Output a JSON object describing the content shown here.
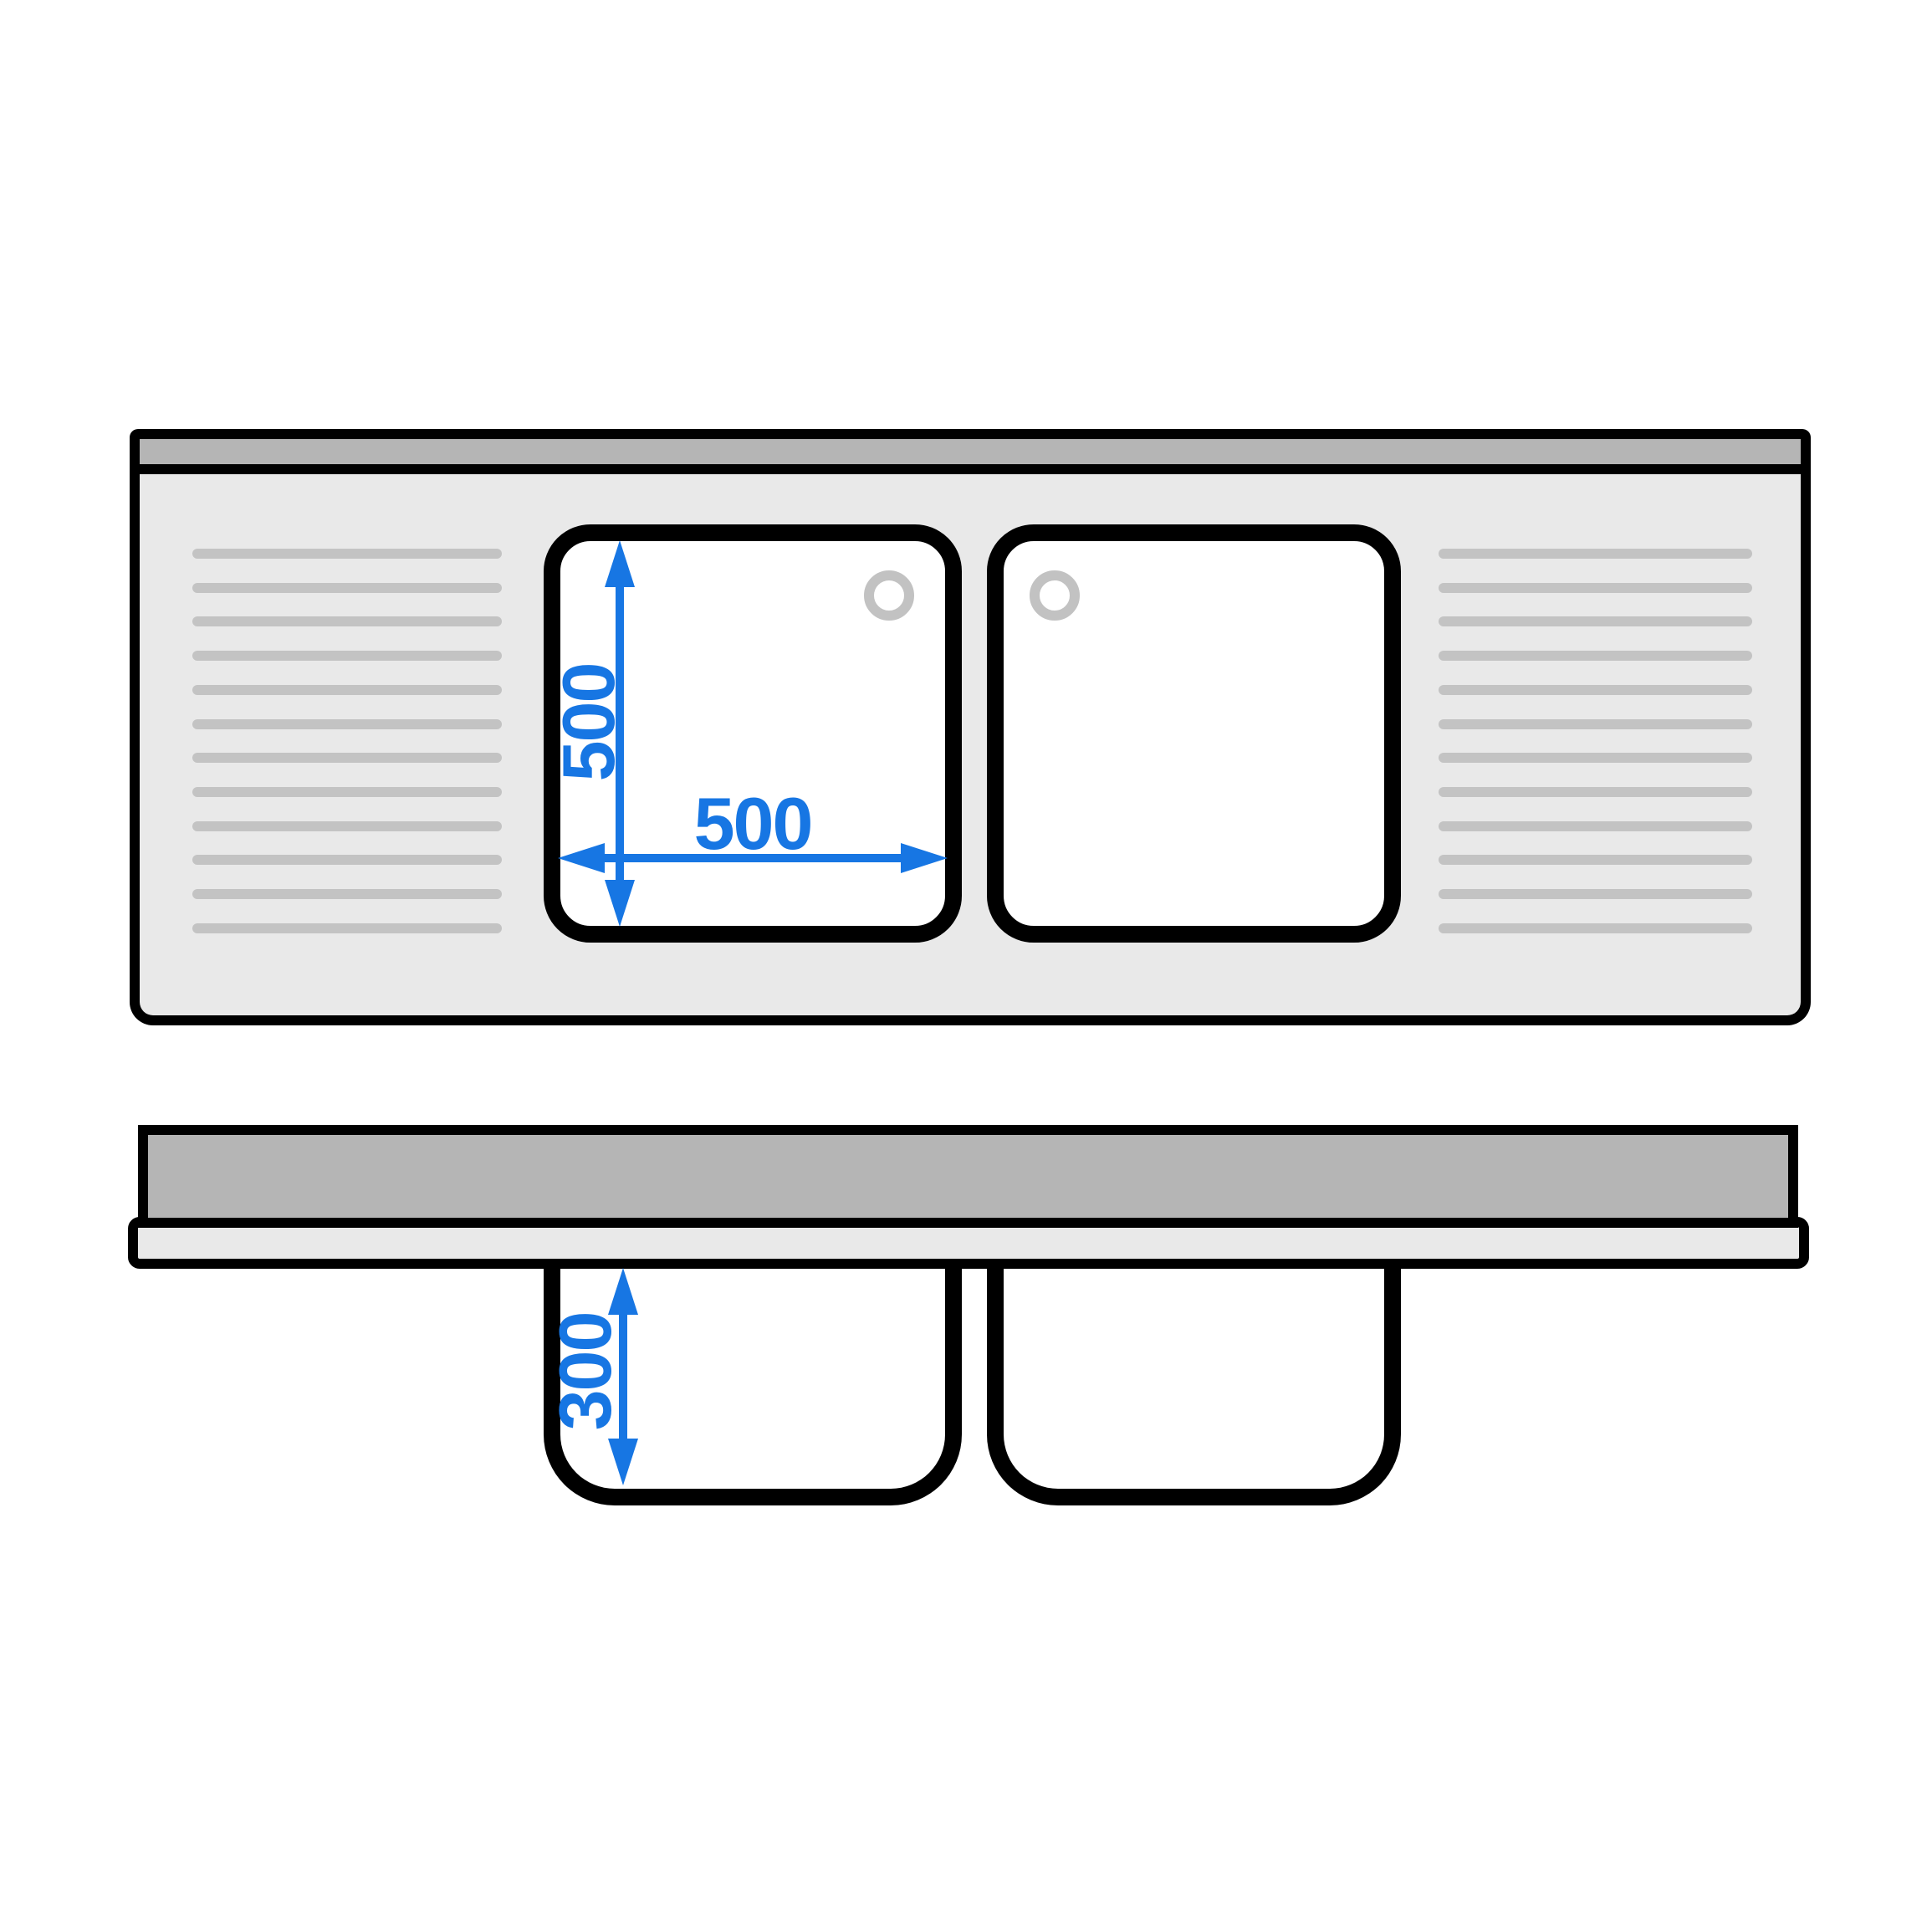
{
  "diagram": {
    "kind": "sink-technical-drawing",
    "plan_view": {
      "basin_count": 2,
      "drain_hole_count": 2,
      "groove_rows_per_side": 12,
      "dimensions": {
        "basin_depth": "500",
        "basin_width": "500"
      }
    },
    "side_view": {
      "bowl_count": 2,
      "dimensions": {
        "bowl_height": "300"
      }
    },
    "colors": {
      "outline": "#000000",
      "worktop_fill": "#e9e9e9",
      "splashback_fill": "#b5b5b5",
      "groove_line": "#c3c3c3",
      "drain_ring": "#c2c2c2",
      "basin_fill": "#ffffff",
      "dimension_accent": "#1776e3"
    }
  }
}
